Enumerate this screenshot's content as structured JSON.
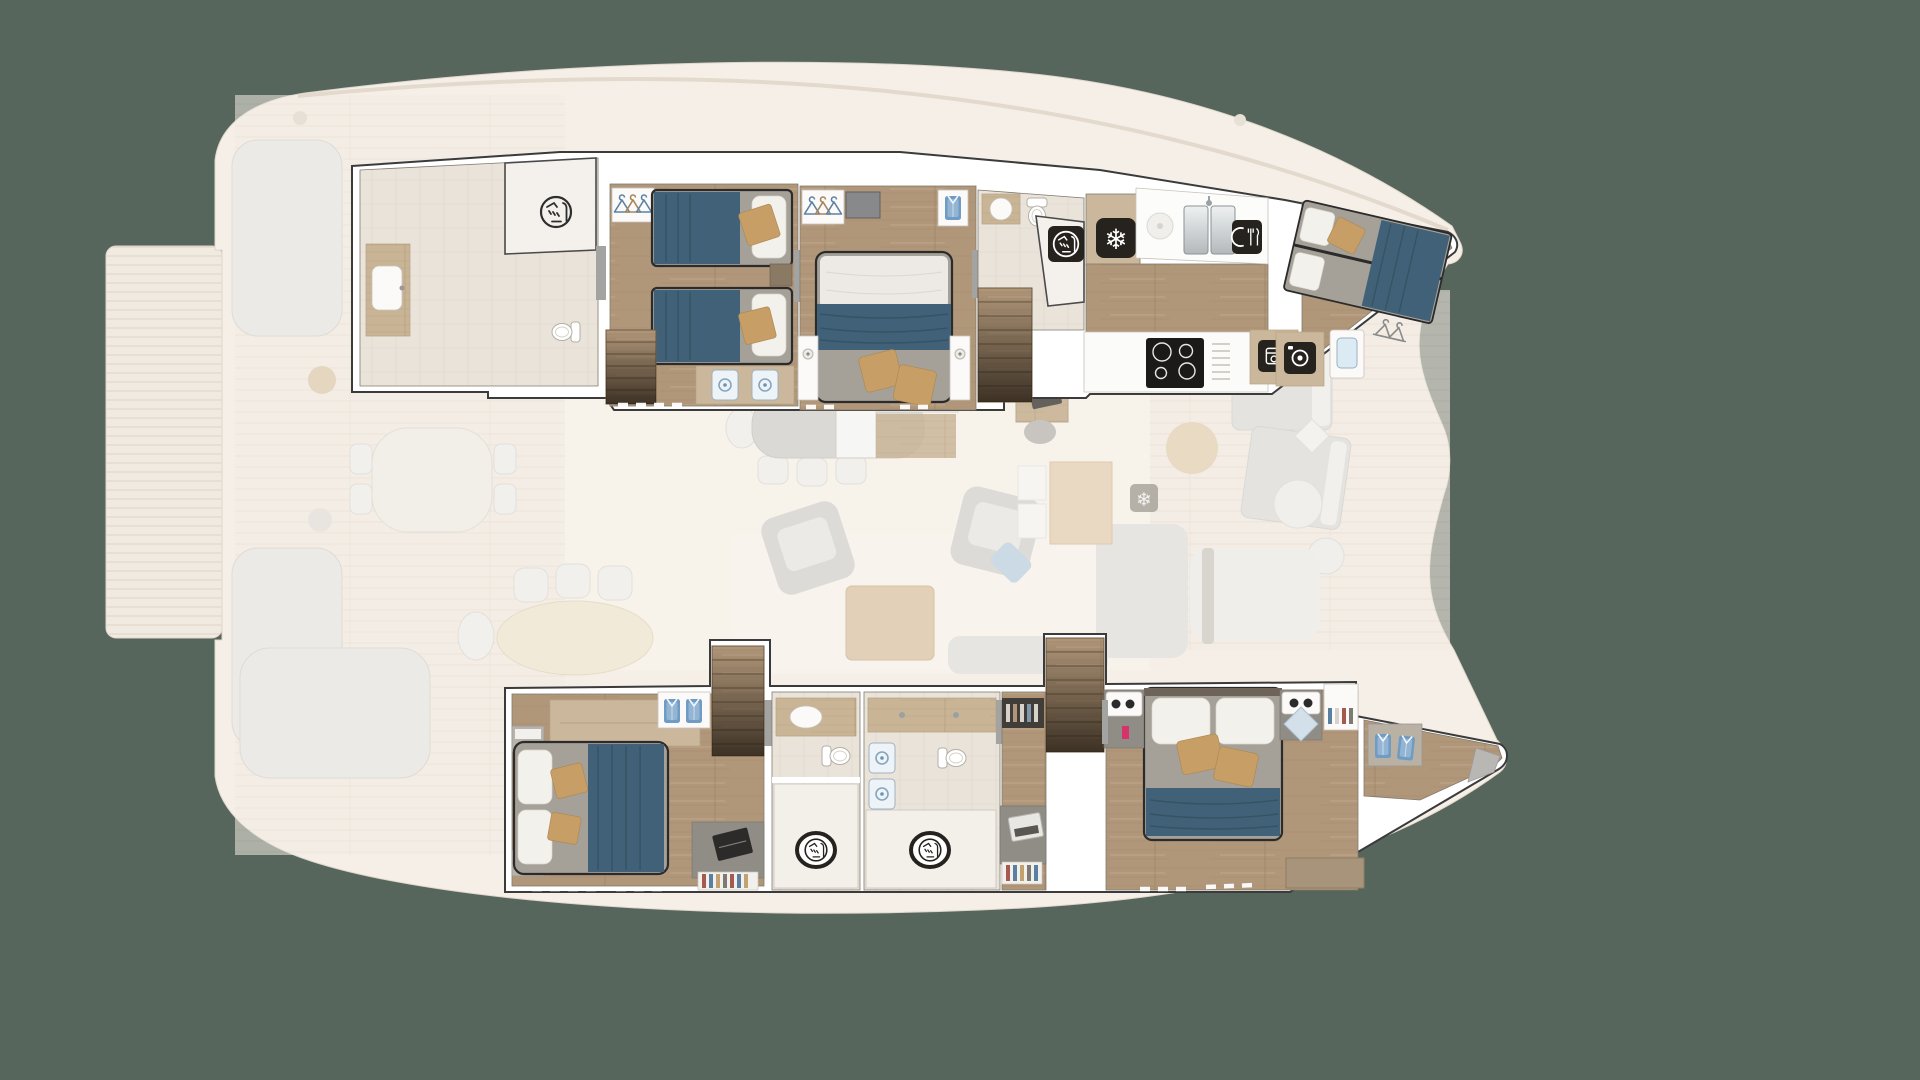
{
  "app": {
    "type": "yacht-floorplan-render",
    "subject": "Catamaran lower deck layout over ghosted main deck",
    "background_color": "#57665c",
    "orientation": "bow to the right, stern to the left"
  },
  "palette": {
    "canvas_green": "#57665c",
    "wall_white": "#ffffff",
    "wall_outline": "#3b3b3b",
    "floor_wood": "#b1977a",
    "floor_wood_light": "#c9b496",
    "bathroom_tile": "#e9e3da",
    "bed_duvet_gray": "#a5a098",
    "blanket_blue": "#406177",
    "pillow_white": "#f3f1ec",
    "pillow_tan": "#c79e66",
    "icon_square_dark": "#26221e",
    "ghost_deck": "#f2ece3",
    "ghost_furniture": "#eceae6"
  },
  "icons": {
    "snowflake": {
      "glyph": "❄",
      "meaning": "freezer / fridge"
    },
    "shower": {
      "meaning": "shower cubicle",
      "count": 4
    },
    "cutlery": {
      "meaning": "dishwasher"
    },
    "oven": {
      "meaning": "oven"
    },
    "washer": {
      "meaning": "washing machine"
    },
    "hanger": {
      "meaning": "wardrobe hanging space"
    },
    "folded_shirt": {
      "meaning": "wardrobe shelf storage"
    }
  },
  "ghost_main_deck": {
    "opacity_style": "washed-out cream tones",
    "areas": [
      "stern slatted swim platform",
      "aft cockpit sofas and lounge with tan pillows",
      "forward cockpit table with chairs",
      "aft oval dining table with three chairs",
      "salon dining table for seven",
      "two rotated lounge armchairs with light-blue cushion",
      "square wooden coffee table on pale rug",
      "chaise sofa and bench",
      "galley island (ghost) with snowflake fridge icon",
      "foredeck with two ghost sunpads, round table and round loungers",
      "starboard stern steps and mast post"
    ]
  },
  "mid_deck_visible": {
    "galley_up_counter": "L-shaped white counter with dark freezer square (snowflake icon) and wood floor",
    "nav_station": "wood desk with dark laptop and chair"
  },
  "port_hull_top": {
    "label": "Port hull — lower deck (top of image)",
    "rooms": [
      {
        "id": "ensuite-aft-port",
        "name": "Aft en-suite bathroom",
        "features": [
          "shower cubicle with shower icon",
          "wood vanity with white sink",
          "toilet"
        ]
      },
      {
        "id": "twin-cabin",
        "name": "Twin guest cabin",
        "features": [
          "two single beds, blue blankets, white + tan pillows",
          "wardrobe with three hangers",
          "staircase down",
          "vanity with two blue basins",
          "window dashes"
        ]
      },
      {
        "id": "double-cabin-port",
        "name": "VIP double cabin",
        "features": [
          "double bed, blue runner, two tan pillows",
          "wardrobe with hangers",
          "wall TV",
          "closet with hanging shirt",
          "two nightstands with lamps"
        ]
      },
      {
        "id": "ensuite-fwd-port",
        "name": "Forward en-suite bathroom",
        "features": [
          "round sink vanity",
          "toilet",
          "shower with dark icon square"
        ]
      },
      {
        "id": "stairs-port",
        "name": "Companionway staircase"
      },
      {
        "id": "freezer-nook",
        "name": "Freezer compartment",
        "icon": "snowflake"
      },
      {
        "id": "crew-galley",
        "name": "Crew galley",
        "features": [
          "round hob",
          "double stainless sink with faucet",
          "dishwasher cutlery icon",
          "4-zone induction cooktop",
          "vent slats",
          "oven icon module"
        ]
      },
      {
        "id": "crew-cabin",
        "name": "Crew bunk cabin (bow)",
        "features": [
          "stacked bunks with blue blankets",
          "washing machine icon module",
          "laundry basin",
          "hanging rail"
        ]
      }
    ]
  },
  "starboard_hull_bottom": {
    "label": "Starboard hull — lower deck (bottom of image)",
    "rooms": [
      {
        "id": "owner-cabin",
        "name": "Owner / aft double cabin",
        "features": [
          "double bed head-left with white + tan pillows and blue runner",
          "tan bench seat",
          "wardrobe with two folded shirts",
          "wall shelves",
          "desk with laptop",
          "bookshelf",
          "window dashes"
        ]
      },
      {
        "id": "stairs-stbd-aft",
        "name": "Companionway staircase (aft)"
      },
      {
        "id": "bathroom-a",
        "name": "En-suite bathroom A",
        "features": [
          "wood vanity with sink",
          "toilet",
          "shower room with shower icon"
        ]
      },
      {
        "id": "bathroom-b",
        "name": "En-suite bathroom B",
        "features": [
          "wood vanity band",
          "two blue basins",
          "toilet",
          "shower room with shower icon"
        ]
      },
      {
        "id": "study-nook",
        "name": "Study nook",
        "features": [
          "dark bookshelf",
          "desk with laptop",
          "lower book rack"
        ]
      },
      {
        "id": "stairs-stbd-fwd",
        "name": "Companionway staircase (forward)"
      },
      {
        "id": "double-cabin-stbd",
        "name": "Forward VIP double cabin",
        "features": [
          "double bed head-up, two white + two tan pillows, blue band",
          "two side consoles with trays",
          "pink figurine",
          "light-blue diamond cushion",
          "bookshelf",
          "sideboard"
        ]
      },
      {
        "id": "bow-store",
        "name": "Bow walk-in / forepeak",
        "features": [
          "wardrobe with two folded shirts",
          "gray bulkhead panel"
        ]
      }
    ]
  },
  "counts": {
    "cabins": 5,
    "crew_cabins": 1,
    "bathrooms": 4,
    "staircases": 4,
    "shower_icons": 4,
    "snowflake_icons": 2
  }
}
